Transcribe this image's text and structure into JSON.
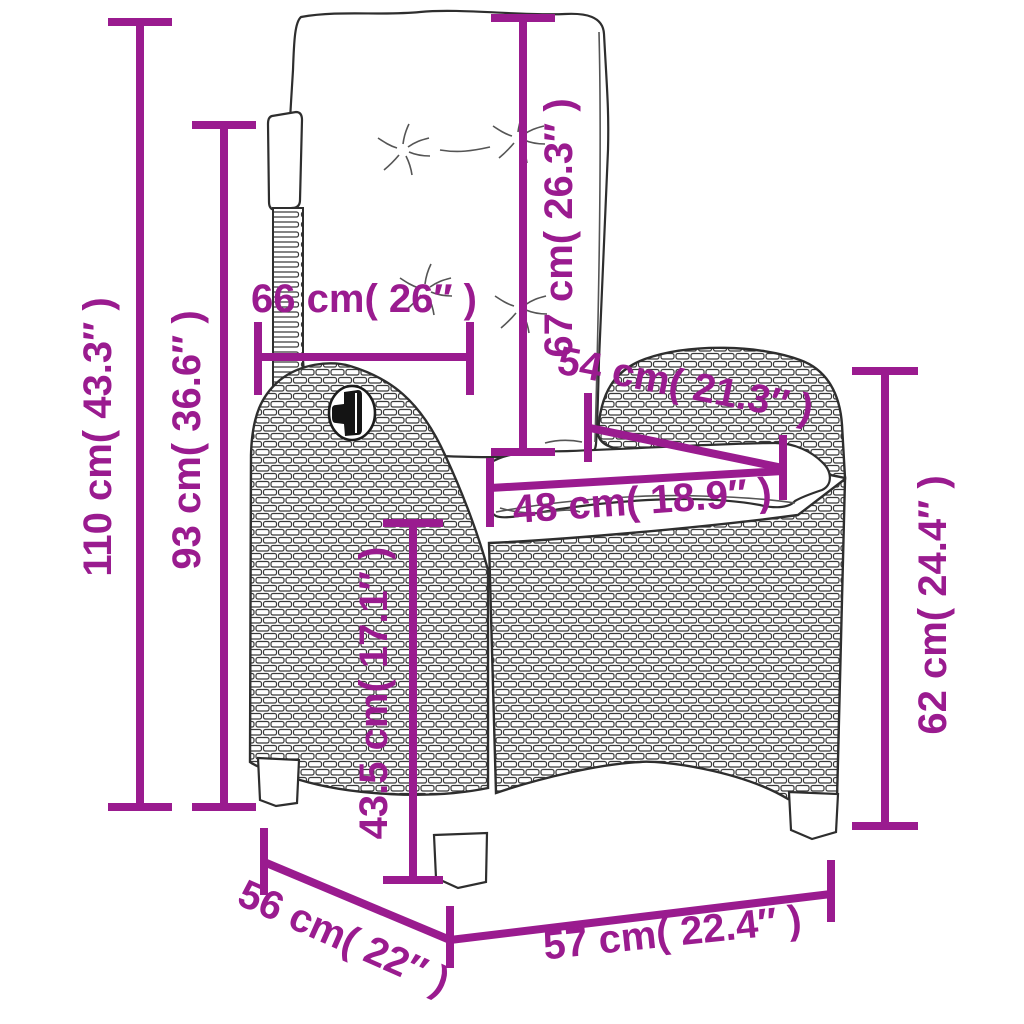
{
  "diagram": {
    "kind": "product-dimension-diagram",
    "product": "reclining-rattan-garden-chair-with-cushions",
    "accent_color": "#9A1B8F",
    "outline_color": "#2e2e2e",
    "background_color": "#ffffff"
  },
  "dimensions": [
    {
      "id": "total-height",
      "cm": "110 cm",
      "inches": "43.3″",
      "label": "110 cm( 43.3″ )",
      "orientation": "vertical"
    },
    {
      "id": "backrest-height",
      "cm": "93 cm",
      "inches": "36.6″",
      "label": "93 cm( 36.6″ )",
      "orientation": "vertical"
    },
    {
      "id": "backrest-width",
      "cm": "66 cm",
      "inches": "26″",
      "label": "66 cm( 26″ )",
      "orientation": "horizontal"
    },
    {
      "id": "backrest-length",
      "cm": "67 cm",
      "inches": "26.3″",
      "label": "67 cm( 26.3″ )",
      "orientation": "vertical"
    },
    {
      "id": "seat-depth",
      "cm": "54 cm",
      "inches": "21.3″",
      "label": "54 cm( 21.3″ )",
      "orientation": "diagonal"
    },
    {
      "id": "seat-width",
      "cm": "48 cm",
      "inches": "18.9″",
      "label": "48 cm( 18.9″ )",
      "orientation": "horizontal"
    },
    {
      "id": "seat-height",
      "cm": "43.5 cm",
      "inches": "17.1″",
      "label": "43.5 cm( 17.1″ )",
      "orientation": "vertical"
    },
    {
      "id": "armrest-height",
      "cm": "62 cm",
      "inches": "24.4″",
      "label": "62 cm( 24.4″ )",
      "orientation": "vertical"
    },
    {
      "id": "base-depth",
      "cm": "56 cm",
      "inches": "22″",
      "label": "56 cm( 22″ )",
      "orientation": "diagonal"
    },
    {
      "id": "base-width",
      "cm": "57 cm",
      "inches": "22.4″",
      "label": "57 cm( 22.4″ )",
      "orientation": "horizontal"
    }
  ]
}
